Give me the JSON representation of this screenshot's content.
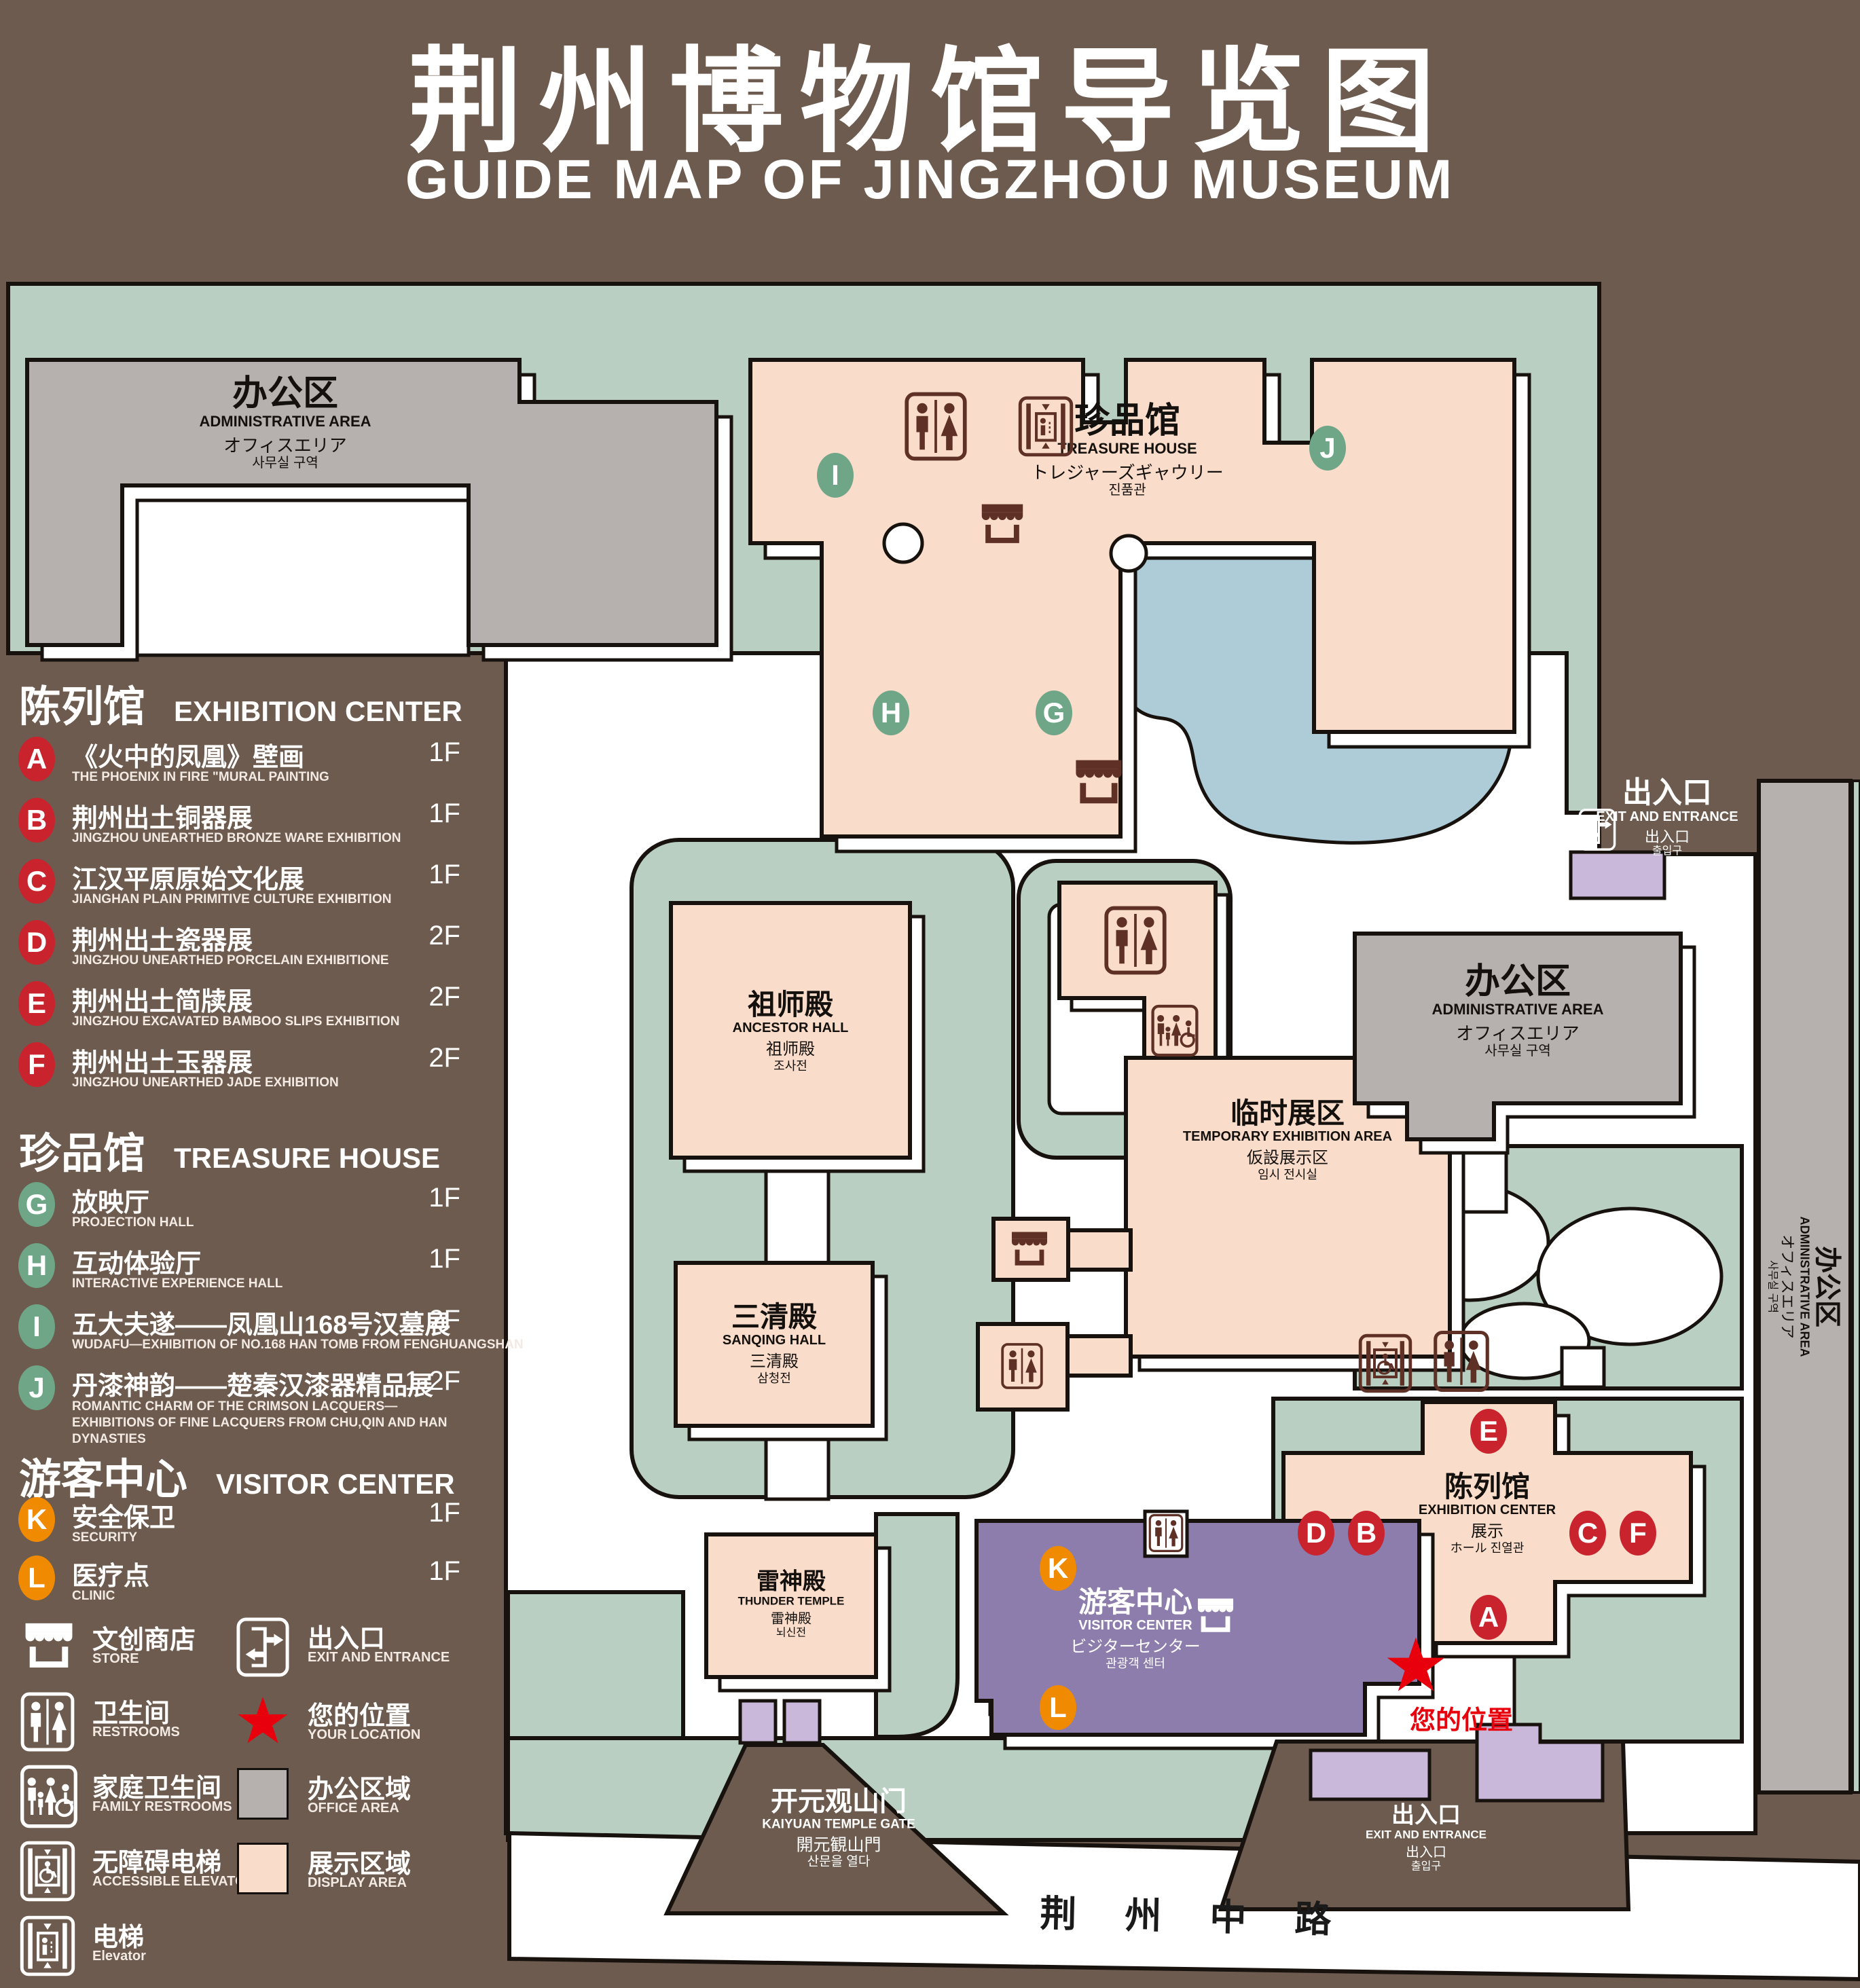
{
  "title": {
    "zh": "荆州博物馆导览图",
    "en": "GUIDE MAP OF JINGZHOU MUSEUM"
  },
  "legend": {
    "sections": [
      {
        "zh": "陈列馆",
        "en": "EXHIBITION CENTER"
      },
      {
        "zh": "珍品馆",
        "en": "TREASURE HOUSE"
      },
      {
        "zh": "游客中心",
        "en": "VISITOR CENTER"
      }
    ],
    "items": [
      {
        "letter": "A",
        "zh": "《火中的凤凰》壁画",
        "en": "THE PHOENIX IN FIRE \"MURAL PAINTING",
        "floor": "1F"
      },
      {
        "letter": "B",
        "zh": "荆州出土铜器展",
        "en": "JINGZHOU UNEARTHED BRONZE WARE EXHIBITION",
        "floor": "1F"
      },
      {
        "letter": "C",
        "zh": "江汉平原原始文化展",
        "en": "JIANGHAN PLAIN PRIMITIVE CULTURE EXHIBITION",
        "floor": "1F"
      },
      {
        "letter": "D",
        "zh": "荆州出土瓷器展",
        "en": "JINGZHOU UNEARTHED PORCELAIN EXHIBITIONE",
        "floor": "2F"
      },
      {
        "letter": "E",
        "zh": "荆州出土简牍展",
        "en": "JINGZHOU EXCAVATED BAMBOO SLIPS EXHIBITION",
        "floor": "2F"
      },
      {
        "letter": "F",
        "zh": "荆州出土玉器展",
        "en": "JINGZHOU UNEARTHED JADE EXHIBITION",
        "floor": "2F"
      },
      {
        "letter": "G",
        "zh": "放映厅",
        "en": "PROJECTION HALL",
        "floor": "1F"
      },
      {
        "letter": "H",
        "zh": "互动体验厅",
        "en": "INTERACTIVE EXPERIENCE HALL",
        "floor": "1F"
      },
      {
        "letter": "I",
        "zh": "五大夫遂——凤凰山168号汉墓展",
        "en": "WUDAFU—EXHIBITION OF NO.168 HAN TOMB FROM FENGHUANGSHAN",
        "floor": "2F"
      },
      {
        "letter": "J",
        "zh": "丹漆神韵——楚秦汉漆器精品展",
        "en": "ROMANTIC CHARM OF THE CRIMSON LACQUERS—EXHIBITIONS OF FINE LACQUERS FROM CHU,QIN AND HAN DYNASTIES",
        "floor": "1-2F"
      },
      {
        "letter": "K",
        "zh": "安全保卫",
        "en": "SECURITY",
        "floor": "1F"
      },
      {
        "letter": "L",
        "zh": "医疗点",
        "en": "CLINIC",
        "floor": "1F"
      }
    ],
    "symbols": [
      {
        "zh": "文创商店",
        "en": "STORE"
      },
      {
        "zh": "卫生间",
        "en": "RESTROOMS"
      },
      {
        "zh": "家庭卫生间",
        "en": "FAMILY RESTROOMS"
      },
      {
        "zh": "无障碍电梯",
        "en": "ACCESSIBLE  ELEVATOR"
      },
      {
        "zh": "电梯",
        "en": "Elevator"
      },
      {
        "zh": "出入口",
        "en": "EXIT AND ENTRANCE"
      },
      {
        "zh": "您的位置",
        "en": "YOUR LOCATION"
      },
      {
        "zh": "办公区域",
        "en": "OFFICE AREA"
      },
      {
        "zh": "展示区域",
        "en": "DISPLAY AREA"
      }
    ]
  },
  "map": {
    "labels": {
      "admin_left": {
        "zh": "办公区",
        "en": "ADMINISTRATIVE AREA",
        "ja": "オフィスエリア",
        "ko": "사무실 구역"
      },
      "treasure": {
        "zh": "珍品馆",
        "en": "TREASURE HOUSE",
        "ja": "トレジャーズギャウリー",
        "ko": "진품관"
      },
      "ancestor": {
        "zh": "祖师殿",
        "en": "ANCESTOR HALL",
        "ja": "祖师殿",
        "ko": "조사전"
      },
      "temporary": {
        "zh": "临时展区",
        "en": "TEMPORARY EXHIBITION AREA",
        "ja": "仮設展示区",
        "ko": "임시 전시실"
      },
      "admin_right": {
        "zh": "办公区",
        "en": "ADMINISTRATIVE AREA",
        "ja": "オフィスエリア",
        "ko": "사무실 구역"
      },
      "admin_road": {
        "zh": "办公区",
        "en": "ADMINISTRATIVE AREA",
        "ja": "オフィスエリア",
        "ko": "사무실 구역"
      },
      "sanqing": {
        "zh": "三清殿",
        "en": "SANQING HALL",
        "ja": "三清殿",
        "ko": "삼청전"
      },
      "thunder": {
        "zh": "雷神殿",
        "en": "THUNDER TEMPLE",
        "ja": "雷神殿",
        "ko": "뇌신전"
      },
      "visitor": {
        "zh": "游客中心",
        "en": "VISITOR CENTER",
        "ja": "ビジターセンター",
        "ko": "관광객 센터"
      },
      "exhibition": {
        "zh": "陈列馆",
        "en": "EXHIBITION CENTER",
        "ja": "展示",
        "ko": "ホール 진열관"
      },
      "exit_top": {
        "zh": "出入口",
        "en": "EXIT AND ENTRANCE",
        "ja": "出入口",
        "ko": "출입구"
      },
      "exit_bottom": {
        "zh": "出入口",
        "en": "EXIT AND ENTRANCE",
        "ja": "出入口",
        "ko": "출입구"
      },
      "gate": {
        "zh": "开元观山门",
        "en": "KAIYUAN TEMPLE GATE",
        "ja": "開元観山門",
        "ko": "산문을 열다"
      },
      "road": {
        "zh": "荆 州 中 路"
      },
      "your_location": {
        "zh": "您的位置"
      }
    },
    "badges": [
      "A",
      "B",
      "C",
      "D",
      "E",
      "F",
      "G",
      "H",
      "I",
      "J",
      "K",
      "L"
    ]
  },
  "colors": {
    "background": "#6c5b4e",
    "green_area": "#b9cfc2",
    "display_area": "#f9dcca",
    "office_area": "#b6b1ae",
    "water": "#aecbd8",
    "visitor_purple": "#8d7dac",
    "building_purple": "#c9b8d9",
    "icon_brown": "#5e3026",
    "badge_red": "#c9242e",
    "badge_green": "#6ea687",
    "badge_orange": "#f08a00",
    "location_red": "#e8000d"
  }
}
